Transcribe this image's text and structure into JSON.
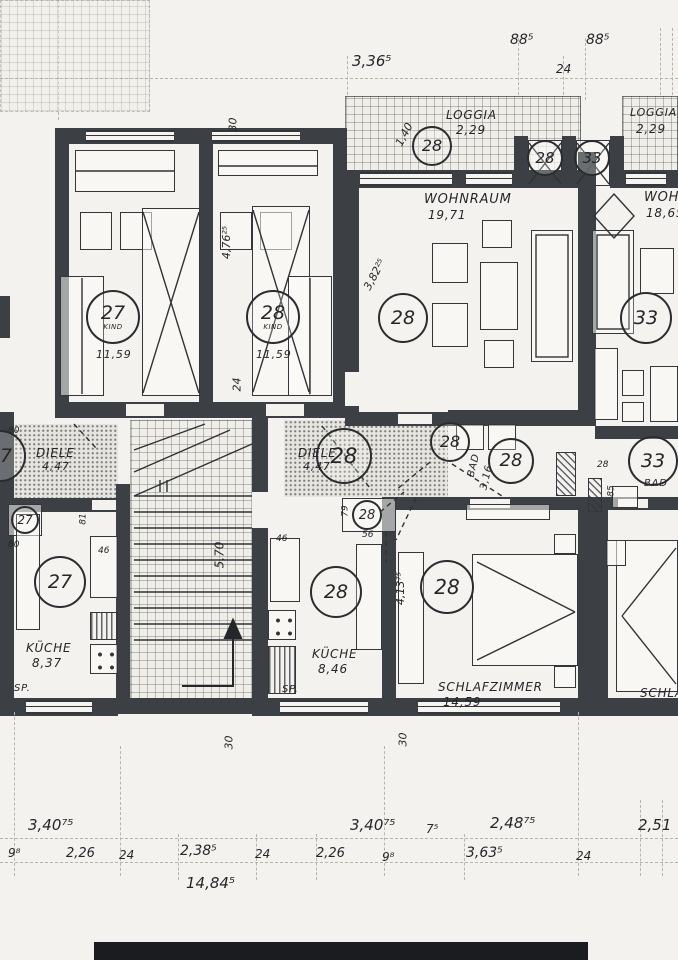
{
  "top_dims": {
    "w1": "3,36⁵",
    "w2": "88⁵",
    "w3": "24",
    "w4": "88⁵"
  },
  "loggia_mid": {
    "name": "LOGGIA",
    "area": "2,29",
    "unit": "28",
    "depth": "1,40"
  },
  "loggia_right": {
    "name": "LOGGIA",
    "area": "2,29"
  },
  "shafts": {
    "left_unit": "28",
    "right_unit": "33"
  },
  "kind_left": {
    "unit": "27",
    "type": "KIND",
    "area": "11,59"
  },
  "kind_right": {
    "unit": "28",
    "type": "KIND",
    "area": "11,59"
  },
  "block_dims": {
    "top": "30",
    "height": "4,76²⁵",
    "wall": "24"
  },
  "wohnraum_mid": {
    "name": "WOHNRAUM",
    "area": "19,71",
    "unit": "28",
    "width": "3,82²⁵"
  },
  "wohnraum_right": {
    "name": "WOHNRAUM",
    "area": "18,65",
    "unit": "33"
  },
  "diele_left": {
    "name": "DIELE",
    "area": "4,47",
    "unit": "27",
    "unit_box": "27",
    "d1": "80",
    "d2": "81",
    "d3": "80"
  },
  "diele_mid": {
    "name": "DIELE",
    "area": "4,47",
    "unit_big": "28",
    "unit_small": "28"
  },
  "bad_mid": {
    "name": "BAD",
    "area": "3,16",
    "unit": "28"
  },
  "bad_right": {
    "name": "BAD",
    "unit": "33",
    "d1": "28",
    "d2": "85"
  },
  "wc_mid": {
    "unit": "28",
    "d1": "79",
    "d2": "56",
    "d3": "46"
  },
  "stair": {
    "run": "5,70"
  },
  "kueche_left": {
    "name": "KÜCHE",
    "area": "8,37",
    "unit": "27",
    "sp": "SP.",
    "d1": "46"
  },
  "kueche_mid": {
    "name": "KÜCHE",
    "area": "8,46",
    "unit": "28",
    "sp": "SP.",
    "d1": "46"
  },
  "schlaf_mid": {
    "name": "SCHLAFZIMMER",
    "area": "14,59",
    "unit": "28",
    "width": "4,13⁷⁵"
  },
  "schlaf_right": {
    "name": "SCHLAFZIMMER"
  },
  "bottom_wall_dims": {
    "d1": "30",
    "d2": "30"
  },
  "dims_row1": {
    "a": "3,40⁷⁵",
    "b": "3,40⁷⁵",
    "c": "7⁵",
    "d": "2,48⁷⁵",
    "e": "2,51"
  },
  "dims_row2": {
    "a": "9⁸",
    "b": "2,26",
    "c": "24",
    "d": "2,38⁵",
    "e": "24",
    "f": "2,26",
    "g": "9⁸",
    "h": "3,63⁵",
    "i": "24"
  },
  "dims_total": {
    "t": "14,84⁵"
  }
}
